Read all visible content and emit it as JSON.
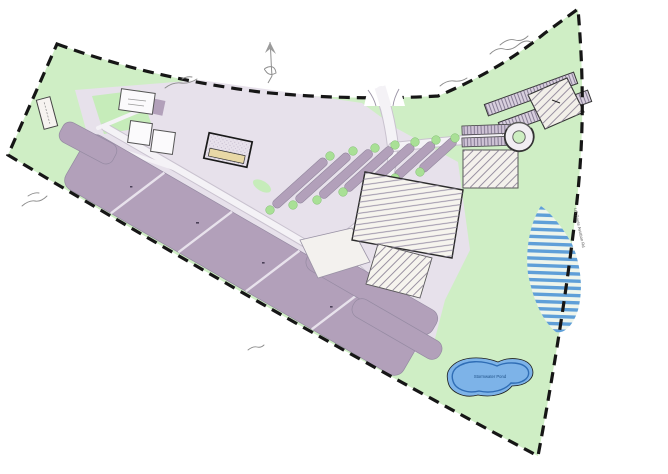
{
  "page": {
    "kind": "scanned land-development site plan (color concept drawing)"
  },
  "labels": {
    "pond": "Stormwater Pond",
    "right_road": "US Route Aviation Rd"
  },
  "annotations_handwritten": [
    "illegible pencil note near top-right boundary",
    "illegible pencil note on upper boundary",
    "illegible pencil note upper-left",
    "illegible pencil note on left boundary",
    "illegible pencil note bottom-center"
  ],
  "icons": {
    "north_arrow": "north-arrow-sketch",
    "roundabout": "traffic-circle"
  },
  "features": [
    "dashed property boundary (wedge-shaped parcel)",
    "landscaped open space (green)",
    "large diagonal parking lot with lane dividers",
    "tree-lined angled parking rows",
    "central building with hatched roof and plaza",
    "secondary parking bands (south of building)",
    "entrance drive from north boundary",
    "cross road to traffic circle",
    "outbuildings (north-west cluster)",
    "long buildings and hatched building (north-east)",
    "small parking rows and hatched pad (east)",
    "striped wetland area (east edge)",
    "pond (south-east)",
    "north arrow sketch"
  ],
  "colors": {
    "background": "#ffffff",
    "site_green": "#cfeec5",
    "tree_green": "#a9e096",
    "developed": "#e7e1eb",
    "parking": "#b2a0ba",
    "parking_light": "#cfc3d6",
    "road": "#f4f2f6",
    "road_edge": "#bdb4c4",
    "building_fill": "#f6f4ee",
    "building_outline": "#2b2b2b",
    "hatch": "#948ba3",
    "tan_strip": "#e8d8a6",
    "pond_fill": "#7db3e8",
    "pond_edge": "#2f6db5",
    "wetland_stripe": "#5f9fd8",
    "boundary": "#161616",
    "sketch": "#8f8f8f"
  }
}
